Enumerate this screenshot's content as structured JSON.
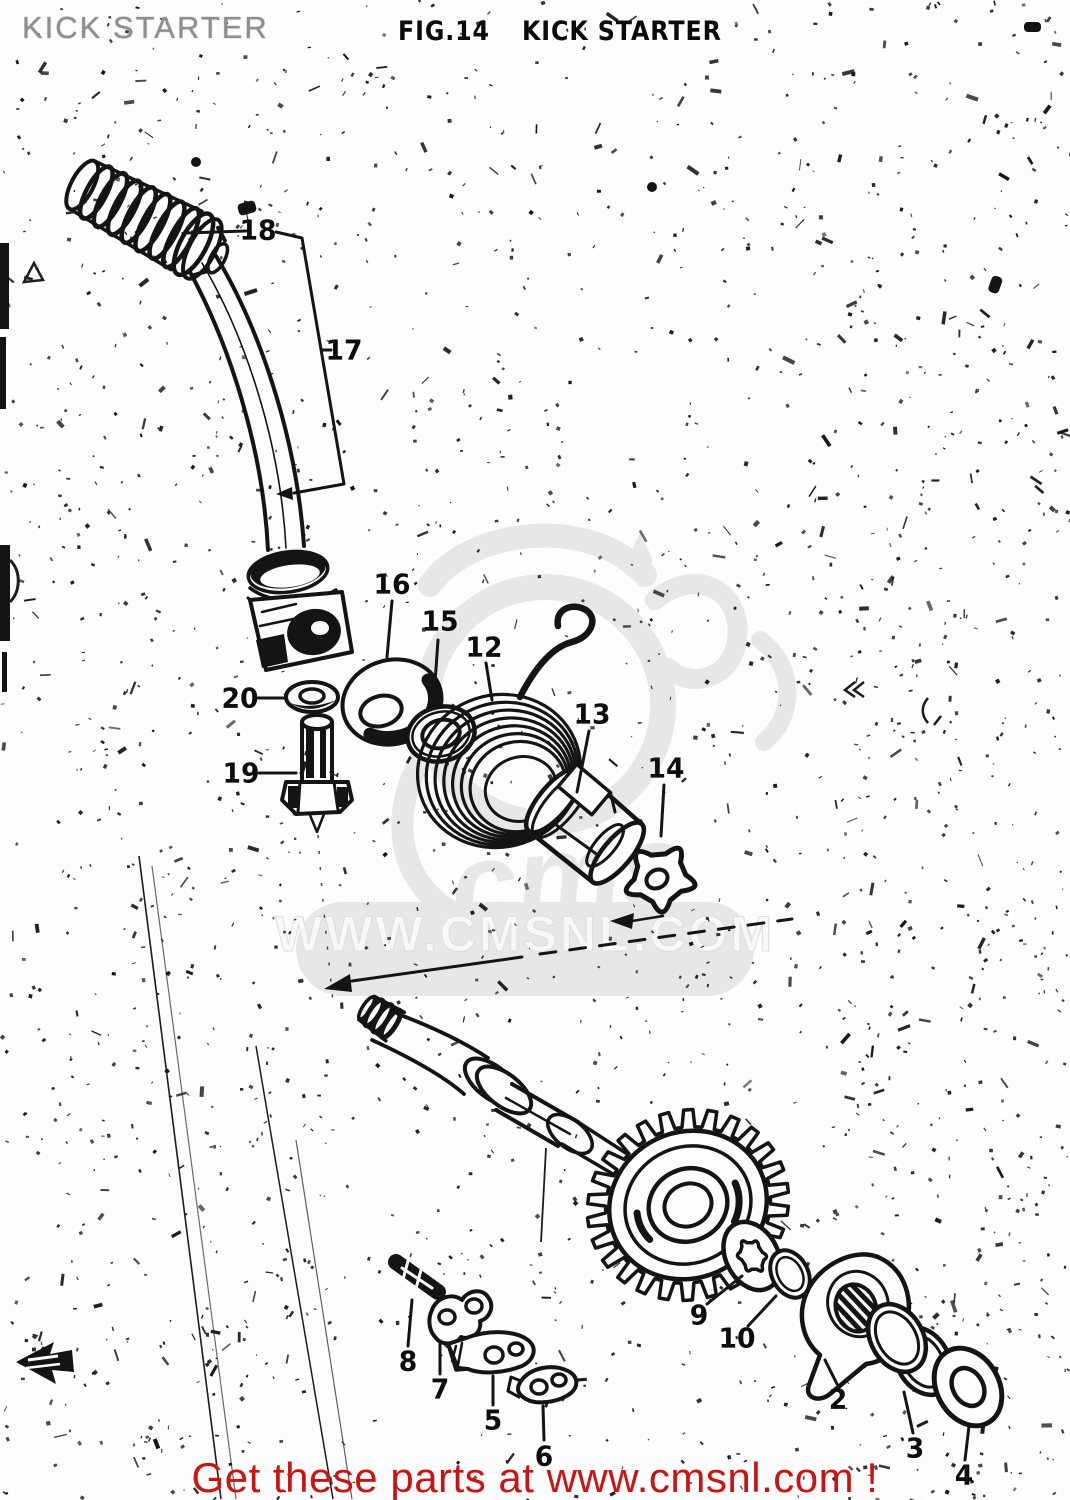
{
  "page": {
    "width": 1070,
    "height": 1500,
    "background": "#fdfdfd",
    "ink": "#141414"
  },
  "header": {
    "stamp": "KICK STARTER",
    "figure_label": "FIG.14",
    "figure_title": "KICK STARTER"
  },
  "watermark": {
    "band_text": "WWW.CMSNL.COM",
    "logo_text": "cms",
    "color": "#e7e7e7"
  },
  "footer": {
    "promo": "Get these parts at www.cmsnl.com !",
    "color": "#cc1212"
  },
  "diagram": {
    "description": "Exploded parts drawing of kick starter assembly",
    "part_labels": [
      {
        "text": "18",
        "x": 258,
        "y": 230,
        "leader": [
          246,
          231,
          186,
          233
        ]
      },
      {
        "text": "17",
        "x": 344,
        "y": 350,
        "leader": [
          331,
          350,
          321,
          350
        ]
      },
      {
        "text": "16",
        "x": 392,
        "y": 584,
        "leader": [
          392,
          601,
          387,
          657
        ]
      },
      {
        "text": "15",
        "x": 440,
        "y": 621,
        "leader": [
          438,
          640,
          434,
          697
        ]
      },
      {
        "text": "12",
        "x": 484,
        "y": 647,
        "leader": [
          486,
          663,
          492,
          700
        ]
      },
      {
        "text": "13",
        "x": 592,
        "y": 714,
        "leader": [
          589,
          731,
          577,
          792
        ]
      },
      {
        "text": "14",
        "x": 666,
        "y": 768,
        "leader": [
          664,
          785,
          661,
          836
        ]
      },
      {
        "text": "20",
        "x": 240,
        "y": 698,
        "leader": [
          257,
          698,
          284,
          698
        ]
      },
      {
        "text": "19",
        "x": 241,
        "y": 773,
        "leader": [
          259,
          773,
          296,
          773
        ]
      },
      {
        "text": "8",
        "x": 408,
        "y": 1361,
        "leader": [
          408,
          1346,
          412,
          1300
        ]
      },
      {
        "text": "7",
        "x": 440,
        "y": 1389,
        "leader": [
          440,
          1374,
          440,
          1344
        ]
      },
      {
        "text": "5",
        "x": 493,
        "y": 1420,
        "leader": [
          493,
          1405,
          493,
          1376
        ]
      },
      {
        "text": "6",
        "x": 544,
        "y": 1456,
        "leader": [
          544,
          1440,
          543,
          1406
        ]
      },
      {
        "text": "9",
        "x": 699,
        "y": 1315,
        "leader": [
          707,
          1304,
          742,
          1276
        ]
      },
      {
        "text": "10",
        "x": 737,
        "y": 1338,
        "leader": [
          748,
          1326,
          776,
          1296
        ]
      },
      {
        "text": "2",
        "x": 838,
        "y": 1399,
        "leader": [
          837,
          1384,
          825,
          1360
        ]
      },
      {
        "text": "3",
        "x": 915,
        "y": 1448,
        "leader": [
          913,
          1433,
          904,
          1392
        ]
      },
      {
        "text": "4",
        "x": 964,
        "y": 1475,
        "leader": [
          965,
          1460,
          969,
          1426
        ]
      }
    ]
  }
}
